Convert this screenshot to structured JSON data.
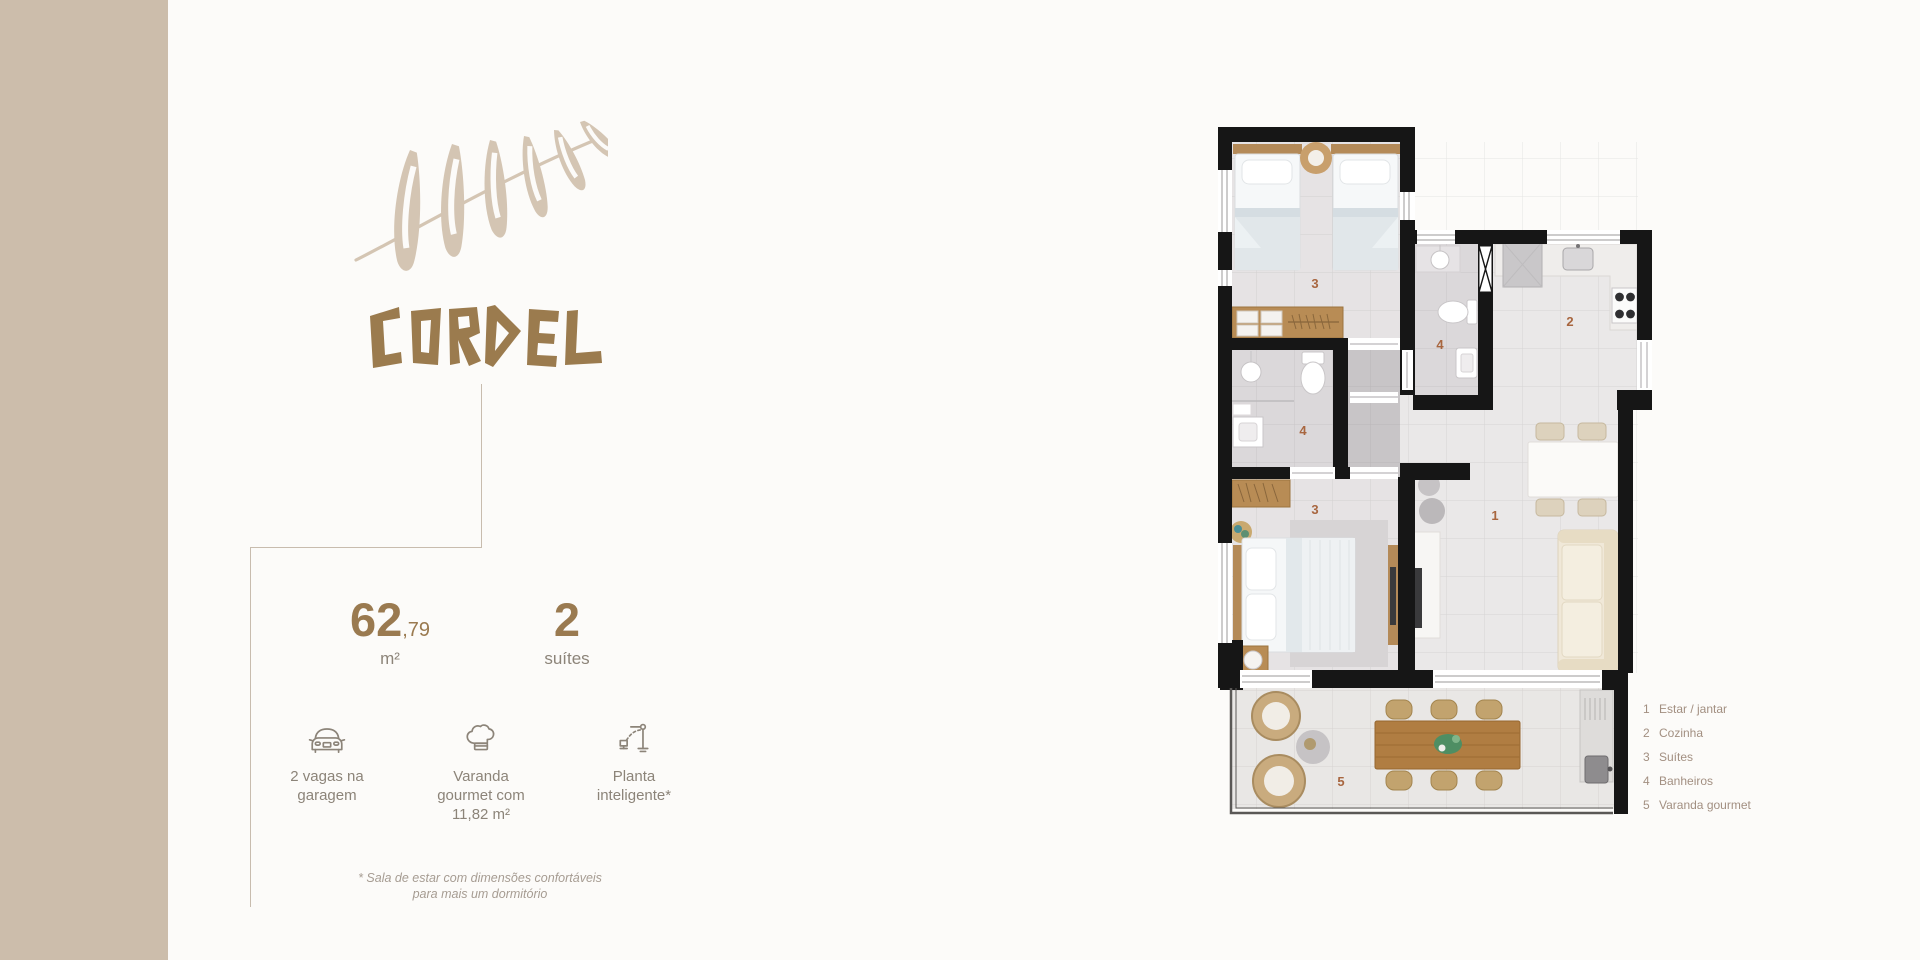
{
  "brand": {
    "name": "CORDEL",
    "logo": "fern-leaf"
  },
  "stats": {
    "area_int": "62",
    "area_dec": ",79",
    "area_unit": "m²",
    "suites_value": "2",
    "suites_label": "suítes"
  },
  "features": [
    {
      "icon": "car-icon",
      "label": "2 vagas na garagem"
    },
    {
      "icon": "chef-hat-icon",
      "label": "Varanda gourmet com 11,82 m²"
    },
    {
      "icon": "smart-plan-icon",
      "label": "Planta inteligente*"
    }
  ],
  "footnote": {
    "line1": "* Sala de estar com dimensões confortáveis",
    "line2": "para mais um dormitório"
  },
  "floorplan": {
    "labels": {
      "suite_top": "3",
      "bath_mid": "4",
      "kitchen": "2",
      "bath_left": "4",
      "suite_bottom": "3",
      "living": "1",
      "varanda": "5"
    },
    "rooms": [
      {
        "number": "1",
        "name": "Estar / jantar"
      },
      {
        "number": "2",
        "name": "Cozinha"
      },
      {
        "number": "3",
        "name": "Suítes"
      },
      {
        "number": "4",
        "name": "Banheiros"
      },
      {
        "number": "5",
        "name": "Varanda gourmet"
      }
    ]
  },
  "colors": {
    "strip": "#ccbdab",
    "brand_brown": "#9b7b4e",
    "leaf": "#d4c5b3",
    "stat_brown": "#9a7a50",
    "text_gray": "#8c8479",
    "plan_number": "#a8663f",
    "wall_black": "#161616"
  }
}
